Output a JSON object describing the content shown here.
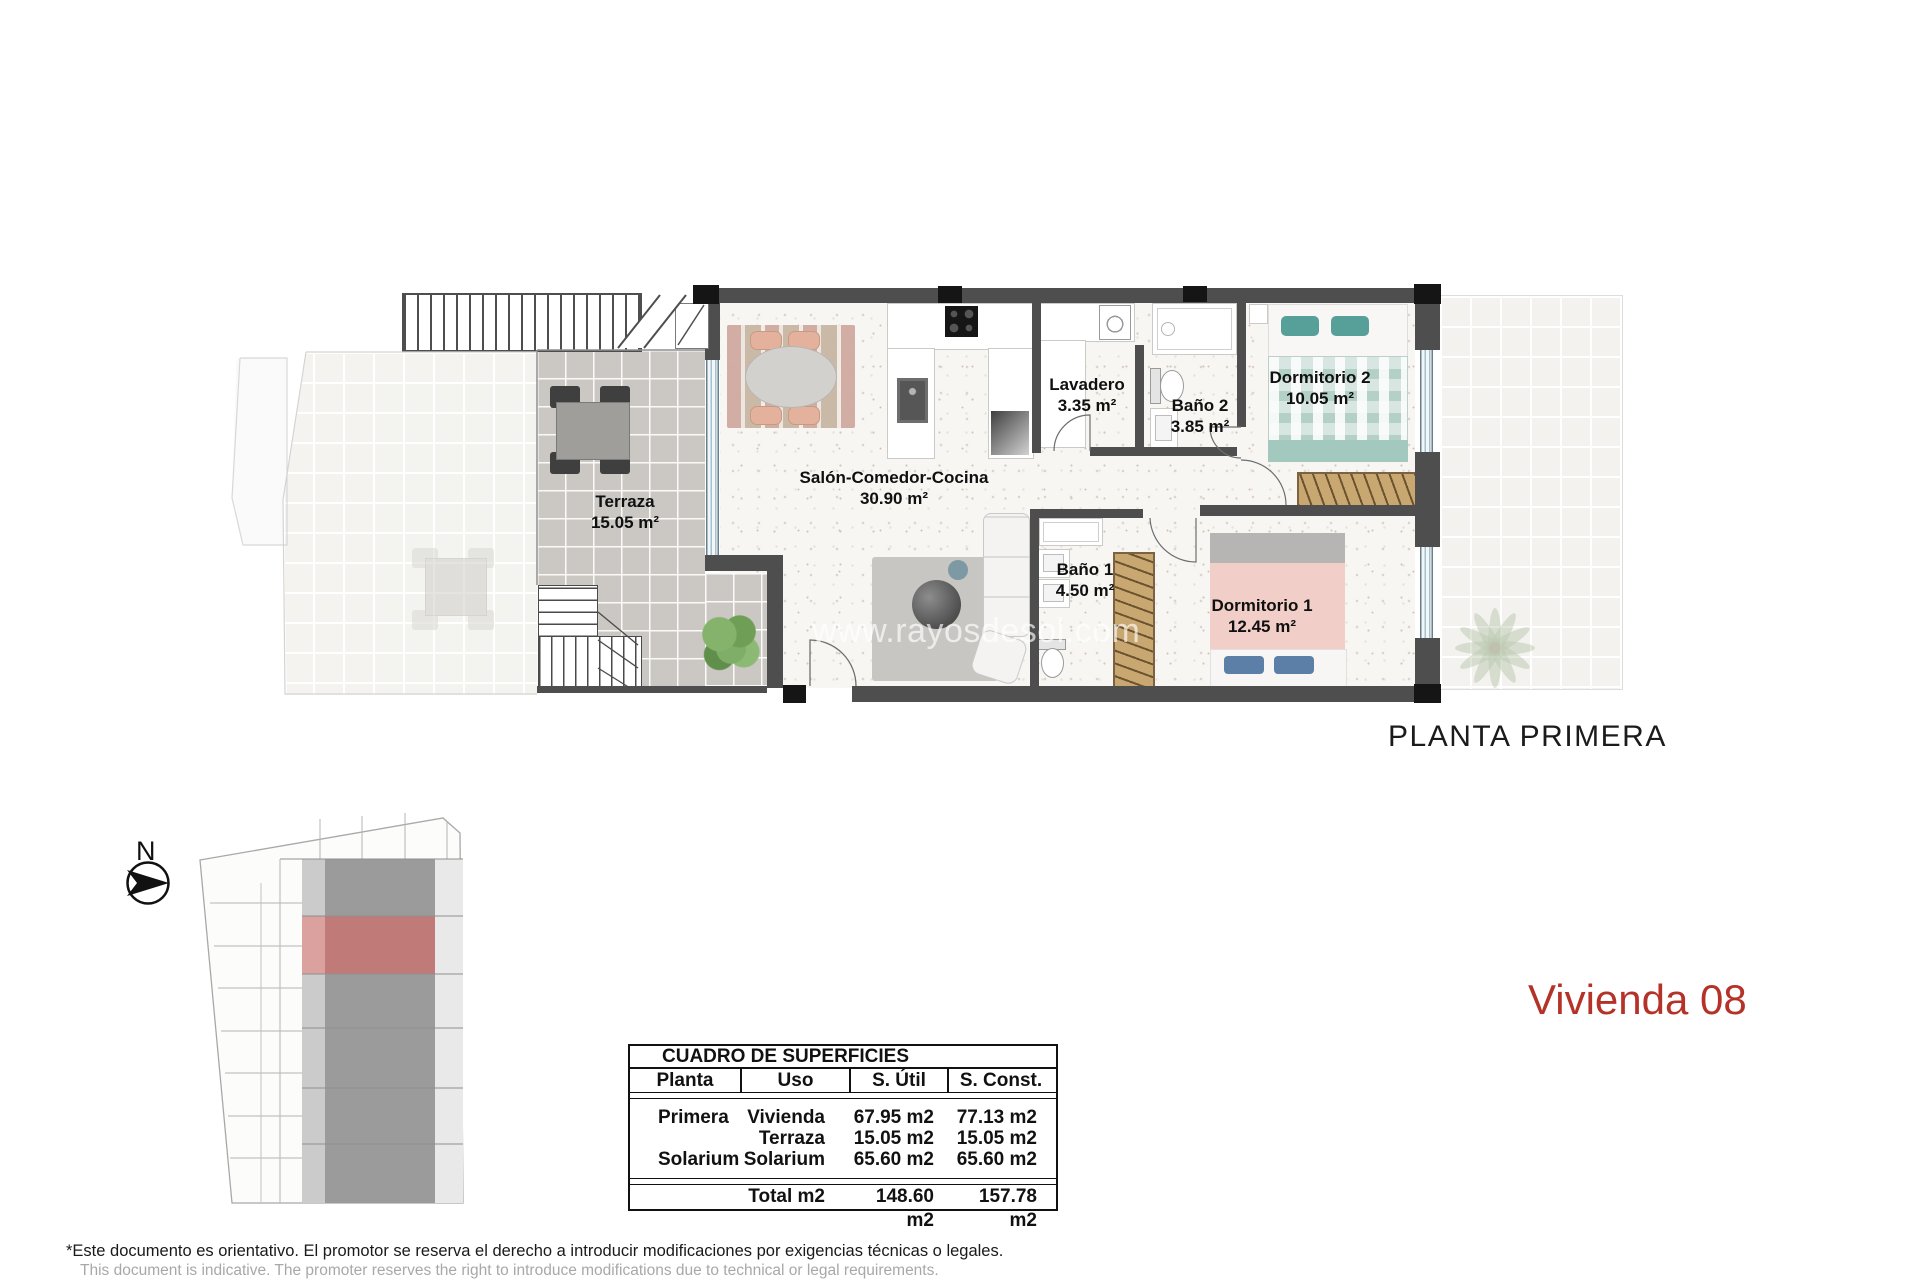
{
  "page": {
    "floor_title": "PLANTA PRIMERA",
    "unit_title": "Vivienda 08",
    "watermark": "www.rayosdesol.com",
    "compass": "N"
  },
  "rooms": {
    "terraza": {
      "name": "Terraza",
      "area": "15.05 m²"
    },
    "salon": {
      "name": "Salón-Comedor-Cocina",
      "area": "30.90 m²"
    },
    "lavadero": {
      "name": "Lavadero",
      "area": "3.35 m²"
    },
    "bano2": {
      "name": "Baño 2",
      "area": "3.85 m²"
    },
    "dormitorio2": {
      "name": "Dormitorio 2",
      "area": "10.05 m²"
    },
    "bano1": {
      "name": "Baño 1",
      "area": "4.50 m²"
    },
    "dormitorio1": {
      "name": "Dormitorio 1",
      "area": "12.45 m²"
    }
  },
  "surfaces_table": {
    "title": "CUADRO DE SUPERFICIES",
    "headers": [
      "Planta",
      "Uso",
      "S. Útil",
      "S. Const."
    ],
    "rows": [
      {
        "planta": "Primera",
        "uso": "Vivienda",
        "util": "67.95 m2",
        "const": "77.13 m2"
      },
      {
        "planta": "",
        "uso": "Terraza",
        "util": "15.05 m2",
        "const": "15.05 m2"
      },
      {
        "planta": "Solarium",
        "uso": "Solarium",
        "util": "65.60 m2",
        "const": "65.60 m2"
      }
    ],
    "total": {
      "label": "Total m2",
      "util": "148.60 m2",
      "const": "157.78 m2"
    }
  },
  "disclaimer": {
    "es": "*Este documento es orientativo. El promotor se reserva el derecho a introducir modificaciones por exigencias técnicas o legales.",
    "en": "This document is indicative. The promoter reserves the right to introduce modifications due to technical or legal requirements."
  },
  "colors": {
    "accent_red": "#b53229",
    "site_highlight": "#c07b78",
    "wall": "#4e4e4e"
  }
}
